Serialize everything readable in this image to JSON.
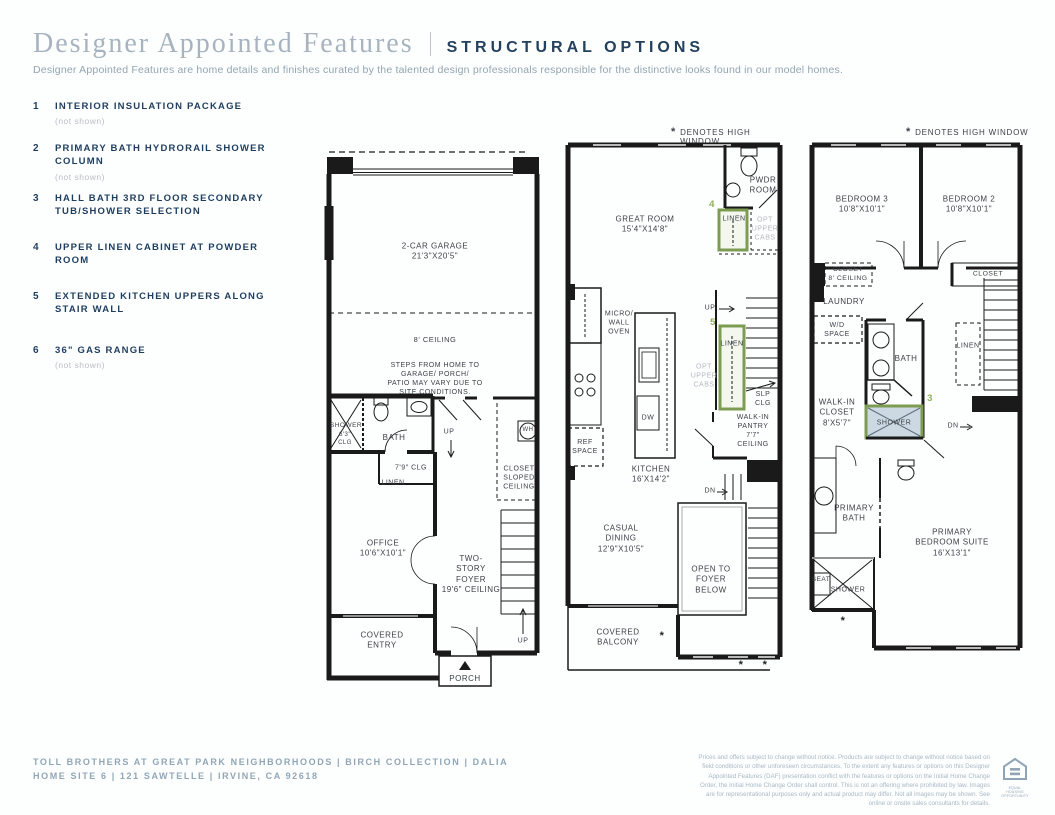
{
  "header": {
    "title_serif": "Designer Appointed Features",
    "title_caps": "STRUCTURAL OPTIONS",
    "subtitle": "Designer Appointed Features are home details and finishes curated by the talented design professionals responsible for the distinctive looks found in our model homes."
  },
  "features": [
    {
      "num": "1",
      "title": "INTERIOR INSULATION PACKAGE",
      "note": "(not shown)"
    },
    {
      "num": "2",
      "title": "PRIMARY BATH HYDRORAIL SHOWER COLUMN",
      "note": "(not shown)"
    },
    {
      "num": "3",
      "title": "HALL BATH 3RD FLOOR SECONDARY TUB/SHOWER SELECTION",
      "note": ""
    },
    {
      "num": "4",
      "title": "UPPER LINEN CABINET AT POWDER ROOM",
      "note": ""
    },
    {
      "num": "5",
      "title": "EXTENDED KITCHEN UPPERS ALONG STAIR WALL",
      "note": ""
    },
    {
      "num": "6",
      "title": "36\" GAS RANGE",
      "note": "(not shown)"
    }
  ],
  "plan1": {
    "garage": "2-CAR GARAGE\n21'3\"X20'5\"",
    "ceiling8": "8' CEILING",
    "steps_note": "STEPS FROM HOME TO GARAGE/ PORCH/\nPATIO MAY VARY DUE TO SITE CONDITIONS.",
    "shower": "SHOWER",
    "shower_clg": "6'3\"\nCLG",
    "bath": "BATH",
    "clg79": "7'9\" CLG",
    "linen": "LINEN",
    "up1": "UP",
    "wh": "WH",
    "closet_sloped": "CLOSET\nSLOPED\nCEILING",
    "office": "OFFICE\n10'6\"X10'1\"",
    "foyer": "TWO-\nSTORY\nFOYER\n19'6\" CEILING",
    "covered_entry": "COVERED\nENTRY",
    "porch": "PORCH",
    "up2": "UP"
  },
  "plan2": {
    "note_star": "*",
    "note": "DENOTES HIGH WINDOW",
    "great_room": "GREAT ROOM\n15'4\"X14'8\"",
    "pwdr": "PWDR\nROOM",
    "num4": "4",
    "linen4": "LINEN",
    "opt_cabs4": "OPT\nUPPER\nCABS",
    "micro": "MICRO/\nWALL\nOVEN",
    "up": "UP",
    "num5": "5",
    "linen5": "LINEN",
    "opt_cabs5": "OPT\nUPPER\nCABS",
    "slp_clg": "SLP CLG",
    "pantry": "WALK-IN\nPANTRY\n7'7\" CEILING",
    "dw": "DW",
    "ref": "REF\nSPACE",
    "kitchen": "KITCHEN\n16'X14'2\"",
    "dn": "DN",
    "casual": "CASUAL\nDINING\n12'9\"X10'5\"",
    "open_foyer": "OPEN TO\nFOYER\nBELOW",
    "balcony": "COVERED\nBALCONY",
    "ast1": "*",
    "ast2": "*",
    "ast3": "*"
  },
  "plan3": {
    "note_star": "*",
    "note": "DENOTES HIGH WINDOW",
    "bedroom3": "BEDROOM 3\n10'8\"X10'1\"",
    "bedroom2": "BEDROOM 2\n10'8\"X10'1\"",
    "closet3": "CLOSET\n8' CEILING",
    "closet2": "CLOSET",
    "laundry": "LAUNDRY",
    "wd": "W/D\nSPACE",
    "bath": "BATH",
    "linen": "LINEN",
    "wic": "WALK-IN\nCLOSET\n8'X5'7\"",
    "num3": "3",
    "shower_opt": "SHOWER",
    "dn": "DN",
    "primary_bath": "PRIMARY\nBATH",
    "primary_suite": "PRIMARY\nBEDROOM SUITE\n16'X13'1\"",
    "seat": "SEAT",
    "shower2": "SHOWER",
    "ast1": "*"
  },
  "footer": {
    "line1": "TOLL BROTHERS AT GREAT PARK NEIGHBORHOODS | BIRCH COLLECTION | DALIA",
    "line2": "HOME SITE 6 | 121 SAWTELLE | IRVINE, CA 92618",
    "disclaimer": "Prices and offers subject to change without notice. Products are subject to change without notice based on field conditions or other unforeseen circumstances. To the extent any features or options on this Designer Appointed Features (DAF) presentation conflict with the features or options on the Initial Home Change Order, the Initial Home Change Order shall control. This is not an offering where prohibited by law. Images are for representational purposes only and actual product may differ. Not all images may be shown. See online or onsite sales consultants for details.",
    "equal_housing_caption": "EQUAL HOUSING\nOPPORTUNITY"
  },
  "colors": {
    "navy": "#1e3e5f",
    "option_green": "#7d9c52",
    "shower_fill": "#ccd9e3",
    "footer_blue": "#91a6b7"
  }
}
